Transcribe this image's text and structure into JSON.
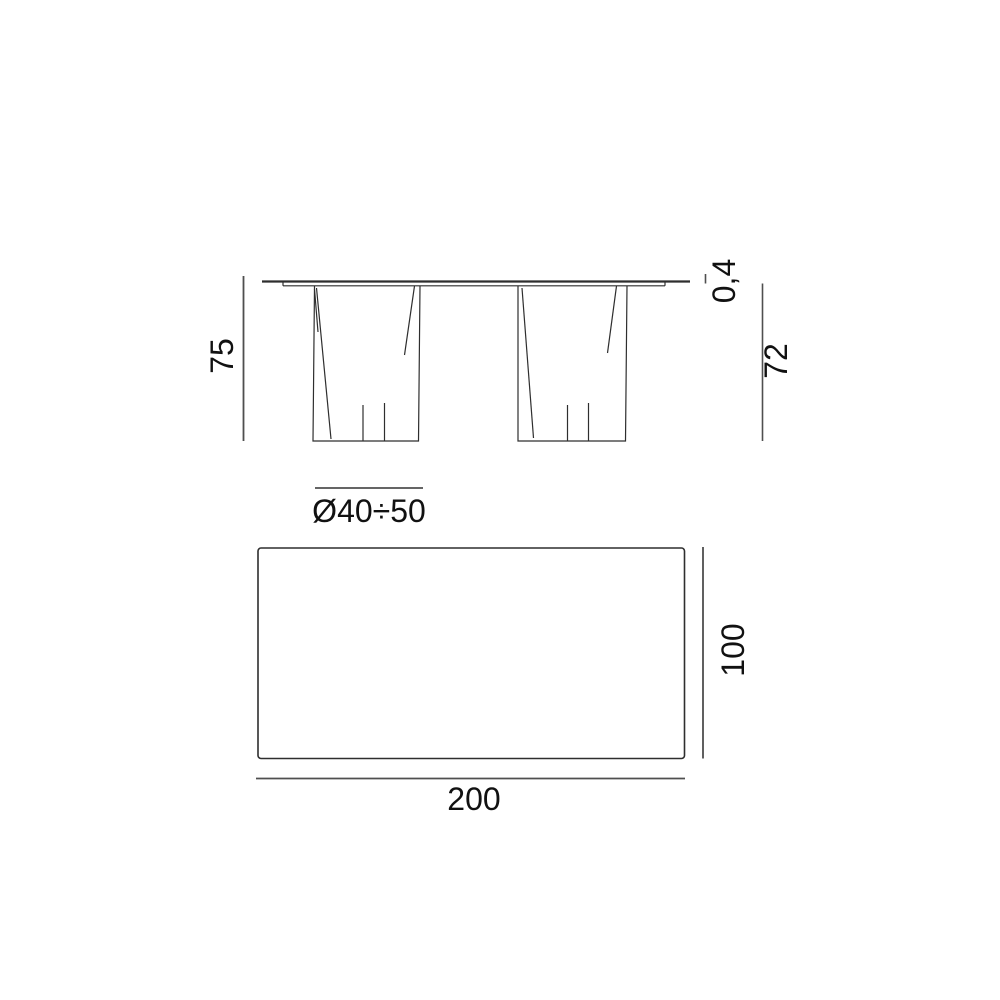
{
  "drawing_title": "table-dimension-drawing",
  "side_view": {
    "overall_height": "75",
    "top_thickness": "0,4",
    "underside_height": "72",
    "leg_diameter_range": "Ø40÷50"
  },
  "top_view": {
    "depth": "100",
    "width": "200"
  },
  "colors": {
    "line": "#2e2e2e",
    "dimension_line": "#4f4f4f",
    "text": "#111111",
    "background": "#ffffff"
  }
}
